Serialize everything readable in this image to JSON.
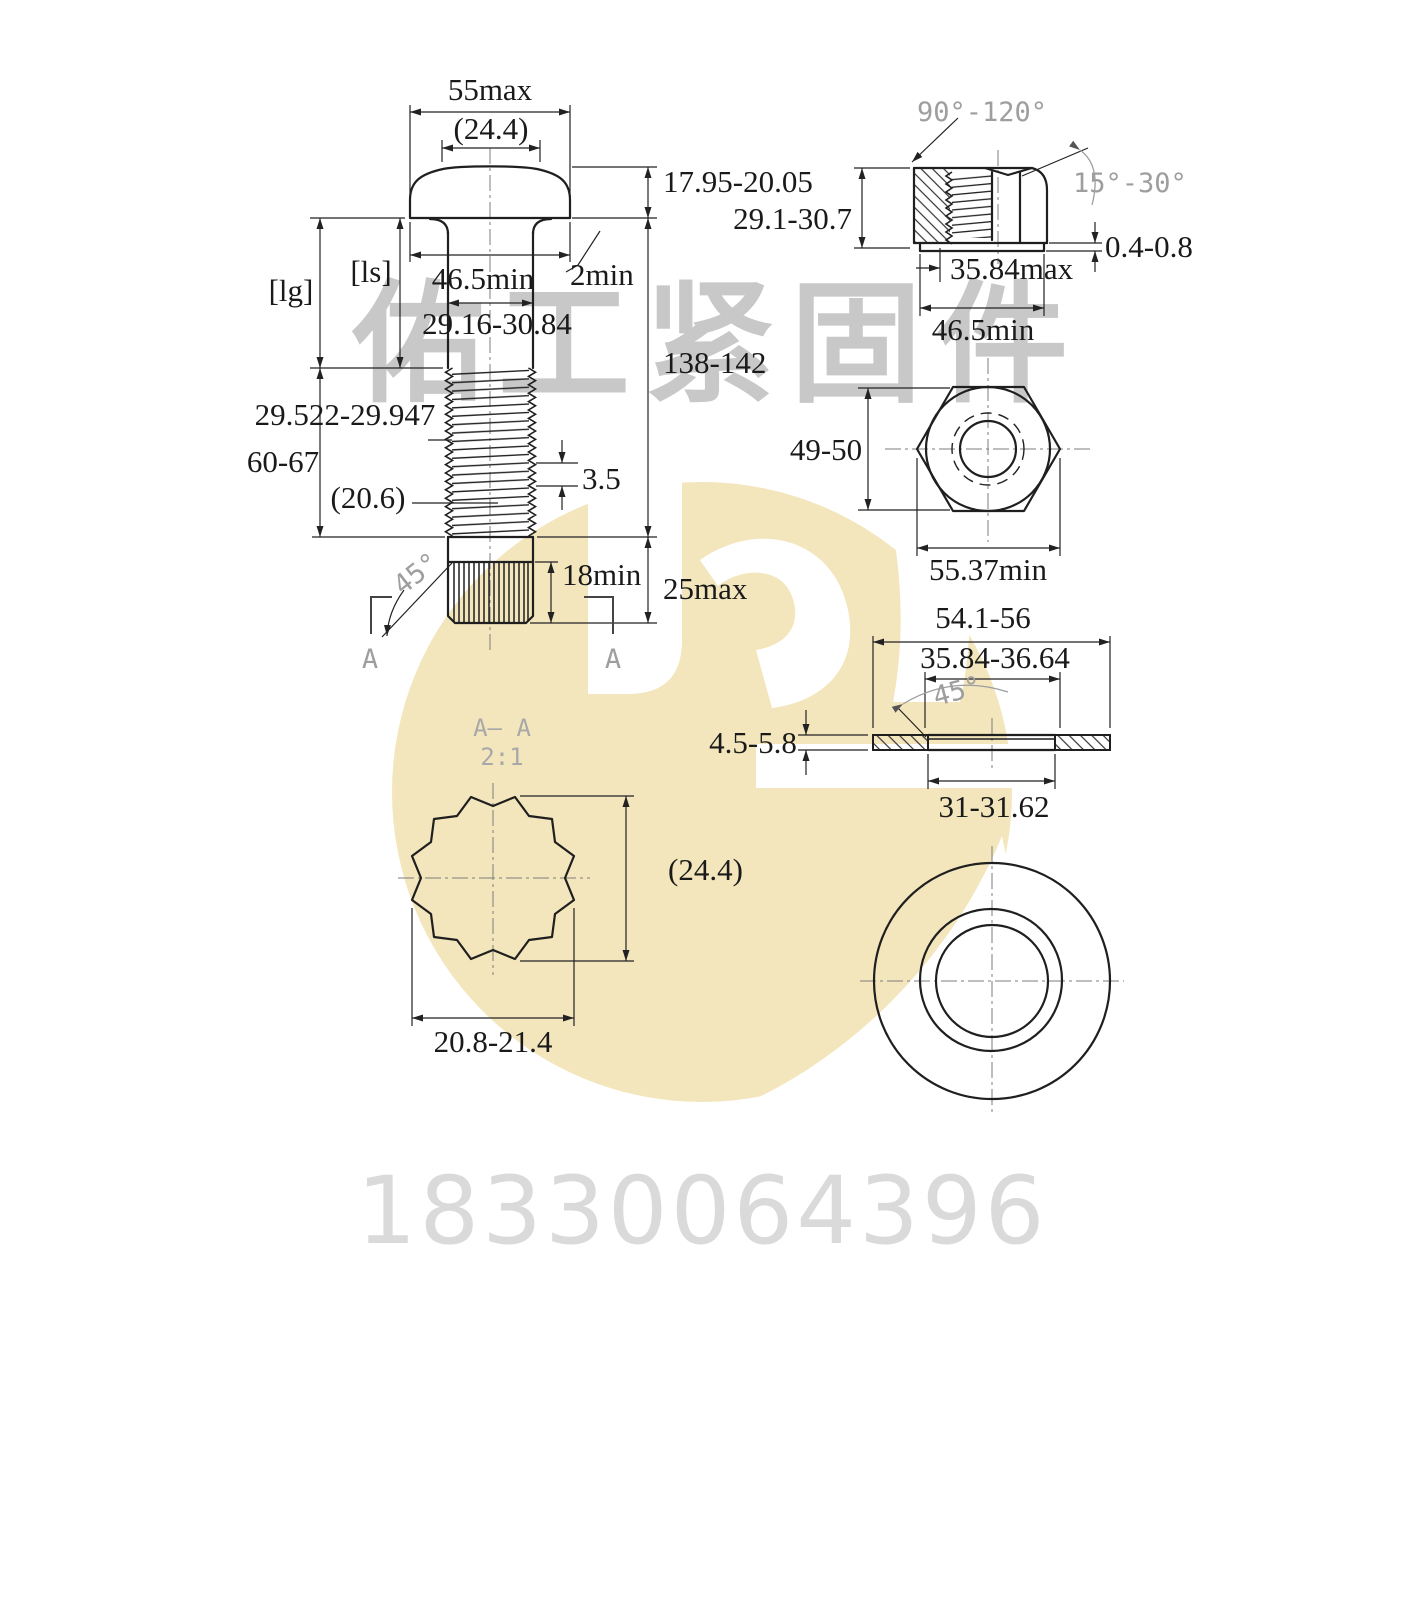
{
  "watermark": {
    "company": "佑工紧固件",
    "phone": "18330064396",
    "logo_color": "#f3e6bc",
    "company_text_color": "#c8c8c8",
    "phone_text_color": "#dadada"
  },
  "bolt": {
    "head_width": "55max",
    "spline_dia_ref": "(24.4)",
    "head_height": "17.95-20.05",
    "grip_label": "[lg]",
    "shank_label": "[ls]",
    "bearing_dia": "46.5min",
    "fillet": "2min",
    "shank_dia": "29.16-30.84",
    "total_length": "138-142",
    "thread_dia": "29.522-29.947",
    "thread_length": "60-67",
    "thread_pitch": "3.5",
    "thread_runout": "(20.6)",
    "chamfer_angle": "45°",
    "spline_length": "18min",
    "end_length": "25max",
    "section_label_left": "A",
    "section_label_right": "A"
  },
  "nut": {
    "cone_angle": "90°-120°",
    "chamfer_angle": "15°-30°",
    "height": "29.1-30.7",
    "washer_face_height": "0.4-0.8",
    "bore_dia": "35.84max",
    "bearing_dia": "46.5min",
    "across_flats": "49-50",
    "across_corners": "55.37min"
  },
  "washer": {
    "outer_dia": "54.1-56",
    "chamfer_dia": "35.84-36.64",
    "chamfer_angle": "45°",
    "thickness": "4.5-5.8",
    "inner_dia": "31-31.62"
  },
  "section": {
    "title": "A— A",
    "scale": "2:1",
    "outer_dia_ref": "(24.4)",
    "across_flats": "20.8-21.4"
  }
}
